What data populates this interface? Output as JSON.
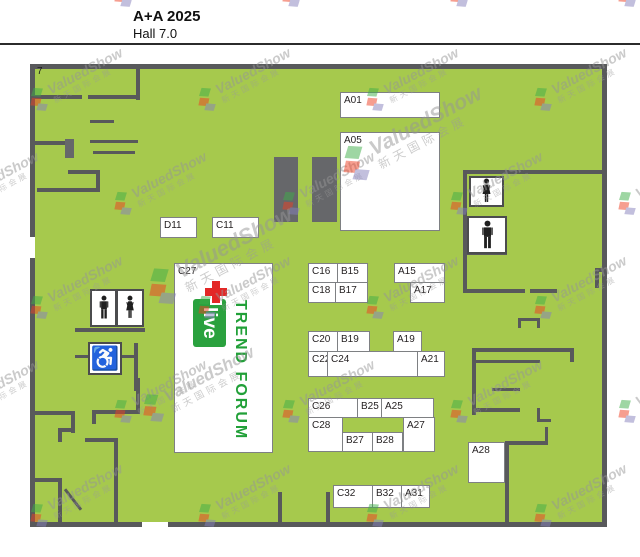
{
  "header": {
    "title": "A+A 2025",
    "subtitle": "Hall 7.0"
  },
  "hall": {
    "corner_label": "7"
  },
  "booths": {
    "a01": "A01",
    "a05": "A05",
    "d11": "D11",
    "c11": "C11",
    "c27": "C27",
    "c16": "C16",
    "b15": "B15",
    "c18": "C18",
    "b17": "B17",
    "a15": "A15",
    "a17": "A17",
    "c20": "C20",
    "b19": "B19",
    "a19": "A19",
    "c22": "C22",
    "c24": "C24",
    "a21": "A21",
    "c26": "C26",
    "b25": "B25",
    "a25": "A25",
    "c28": "C28",
    "b27": "B27",
    "b28": "B28",
    "a27": "A27",
    "c32": "C32",
    "b32": "B32",
    "a31": "A31",
    "a28": "A28"
  },
  "trend_forum": {
    "name": "TREND FORUM",
    "live": "live"
  },
  "watermark": {
    "brand": "ValuedShow",
    "chinese": "新天国际会展"
  },
  "icons": {
    "wheelchair_glyph": "♿"
  },
  "colors": {
    "floor_green": "#a6c94d",
    "wall_gray": "#58595b",
    "forum_green": "#21a038",
    "live_green": "#2aa13e",
    "cross_red": "#e32726",
    "watermark_gray": "#999999"
  }
}
